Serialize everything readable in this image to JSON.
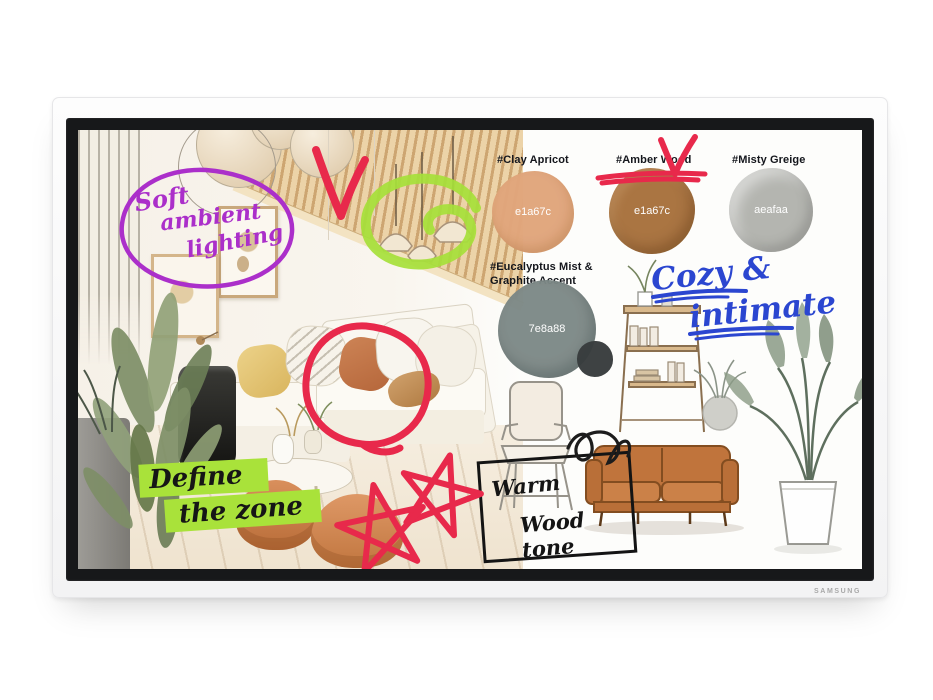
{
  "device": {
    "brand": "SAMSUNG"
  },
  "board": {
    "palette": {
      "swatches": [
        {
          "label": "#Clay Apricot",
          "code": "e1a67c",
          "fill": "#e1a67c"
        },
        {
          "label": "#Amber Wood",
          "code": "e1a67c",
          "fill": "#a8713d"
        },
        {
          "label": "#Misty Greige",
          "code": "aeafaa",
          "fill": "#b2b3ae"
        }
      ],
      "eucalyptus": {
        "label_line1": "#Eucalyptus Mist &",
        "label_line2": "Graphite Accent",
        "code": "7e8a88",
        "fill": "#7e8a88",
        "accent_fill": "#383c3d"
      }
    },
    "notes": {
      "soft_ambient": {
        "lines": [
          "Soft",
          "ambient",
          "lighting"
        ],
        "ink": "#ab2fca"
      },
      "define_zone": {
        "lines": [
          "Define",
          "the zone"
        ],
        "ink": "#161616",
        "highlight": "#a9e23a"
      },
      "cozy_intimate": {
        "lines": [
          "Cozy &",
          "intimate"
        ],
        "ink": "#2b46d0"
      },
      "warm_wood": {
        "lines": [
          "Warm",
          "Wood tone"
        ],
        "ink": "#141414"
      }
    },
    "doodle_ink": {
      "red": "#e8294b",
      "green": "#a6e03a",
      "purple": "#ab2fca",
      "blue": "#2b46d0",
      "black": "#1c1c1c"
    }
  }
}
